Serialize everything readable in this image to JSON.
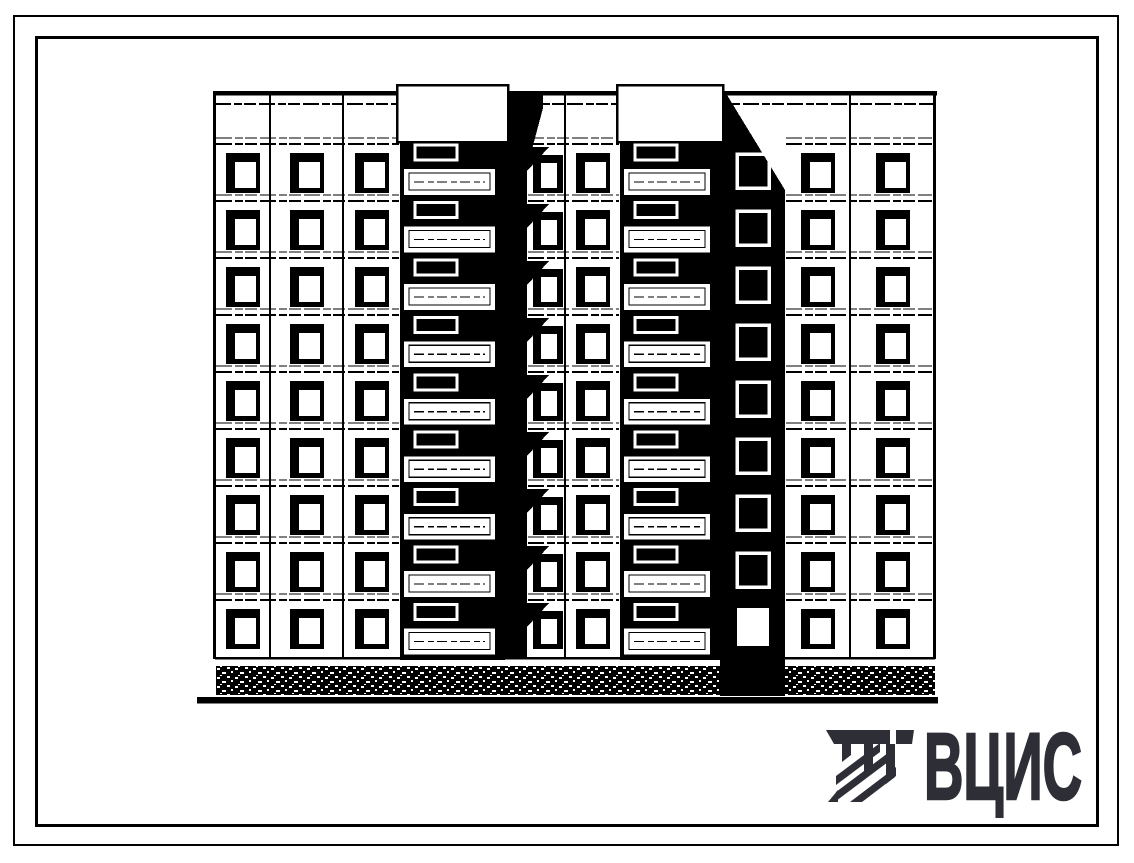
{
  "page": {
    "background": "#ffffff",
    "frame_color": "#000000"
  },
  "logo": {
    "text": "ВЦИС",
    "color": "#2e2e36"
  },
  "figure": {
    "type": "building-elevation",
    "description": "Scanned line drawing: end elevation of a 9-storey large-panel apartment block with two stacked loggia bays, shadow strips, speckled plinth band and heavy ground line",
    "ink": "#000000",
    "paper": "#ffffff",
    "floors": 9,
    "building": {
      "left": 215,
      "right": 935,
      "roof_y": 91,
      "roof_thin_y": 104,
      "stack_parapet_top": 85,
      "stack_parapet_bottom": 142,
      "floor0_top": 148,
      "floor_pitch": 57,
      "facade_bottom": 657,
      "plinth_top": 666,
      "plinth_height": 29,
      "ground_line": {
        "y": 696,
        "x1": 197,
        "x2": 938,
        "thickness": 6.5
      },
      "window": {
        "w": 34,
        "h": 40
      }
    },
    "columns": [
      {
        "id": "c1",
        "type": "windows",
        "x": 215,
        "w": 55
      },
      {
        "id": "c2",
        "type": "windows",
        "x": 270,
        "w": 73
      },
      {
        "id": "c3",
        "type": "windows",
        "x": 343,
        "w": 57
      },
      {
        "id": "s1",
        "type": "balcony-stack",
        "x": 400,
        "w": 105
      },
      {
        "id": "shA",
        "type": "shadow-strip",
        "x": 505,
        "w": 22,
        "windows": false
      },
      {
        "id": "c4",
        "type": "windows-shadowed",
        "x": 527,
        "w": 38
      },
      {
        "id": "c5",
        "type": "windows",
        "x": 565,
        "w": 55
      },
      {
        "id": "s2",
        "type": "balcony-stack",
        "x": 620,
        "w": 100
      },
      {
        "id": "shB",
        "type": "shadow-strip",
        "x": 720,
        "w": 65,
        "windows": true,
        "diagonal_bottom_y": 190
      },
      {
        "id": "c6",
        "type": "windows",
        "x": 785,
        "w": 65
      },
      {
        "id": "c7",
        "type": "windows",
        "x": 850,
        "w": 85
      }
    ]
  }
}
